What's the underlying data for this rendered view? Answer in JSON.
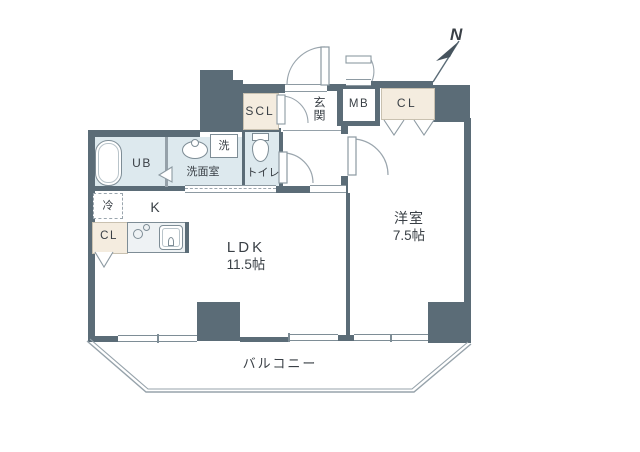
{
  "floorplan": {
    "compass": {
      "label": "N"
    },
    "rooms": {
      "ldk": {
        "name": "LDK",
        "size": "11.5帖"
      },
      "western_room": {
        "name": "洋室",
        "size": "7.5帖"
      },
      "kitchen": {
        "label": "K"
      },
      "entrance": {
        "label": "玄関"
      },
      "washroom": {
        "label": "洗面室"
      },
      "toilet": {
        "label": "トイレ"
      },
      "unit_bath": {
        "label": "UB"
      },
      "balcony": {
        "label": "バルコニー"
      }
    },
    "fixtures": {
      "shoe_closet": "SCL",
      "meter_box": "MB",
      "closet_bedroom": "CL",
      "closet_ldk": "CL",
      "washer": "洗",
      "refrigerator": "冷"
    },
    "colors": {
      "wall": "#5b6c77",
      "wet_area": "#dde9ee",
      "closet": "#f4ecdf",
      "line": "#7e8d96",
      "text": "#3a4046"
    }
  }
}
